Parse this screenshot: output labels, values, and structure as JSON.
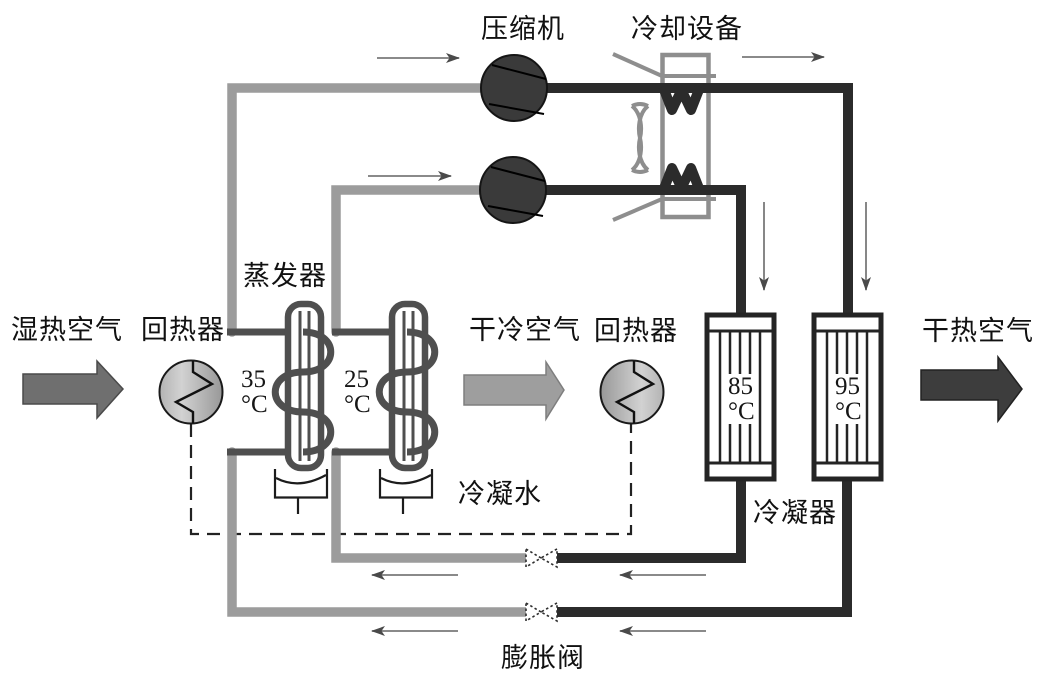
{
  "labels": {
    "compressor": "压缩机",
    "cooling_device": "冷却设备",
    "humid_hot_air": "湿热空气",
    "regenerator_left": "回热器",
    "evaporator": "蒸发器",
    "dry_cold_air": "干冷空气",
    "regenerator_right": "回热器",
    "dry_hot_air": "干热空气",
    "condensate_water": "冷凝水",
    "condenser": "冷凝器",
    "expansion_valve": "膨胀阀"
  },
  "temperatures": {
    "evaporator_stage1": {
      "value": "35",
      "unit": "°C"
    },
    "evaporator_stage2": {
      "value": "25",
      "unit": "°C"
    },
    "condenser_stage1": {
      "value": "85",
      "unit": "°C"
    },
    "condenser_stage2": {
      "value": "95",
      "unit": "°C"
    }
  },
  "colors": {
    "suction_pipe_gray": "#9c9c9c",
    "discharge_pipe_black": "#2b2b2b",
    "evaporator_gray": "#4f4f4f",
    "cooler_outline_gray": "#8e8e8e",
    "compressor_fill": "#3a3a3a",
    "inlet_arrow_fill": "#6f6f6f",
    "dry_cold_arrow_fill": "#9e9e9e",
    "outlet_arrow_fill": "#3d3d3d",
    "background": "#ffffff"
  }
}
